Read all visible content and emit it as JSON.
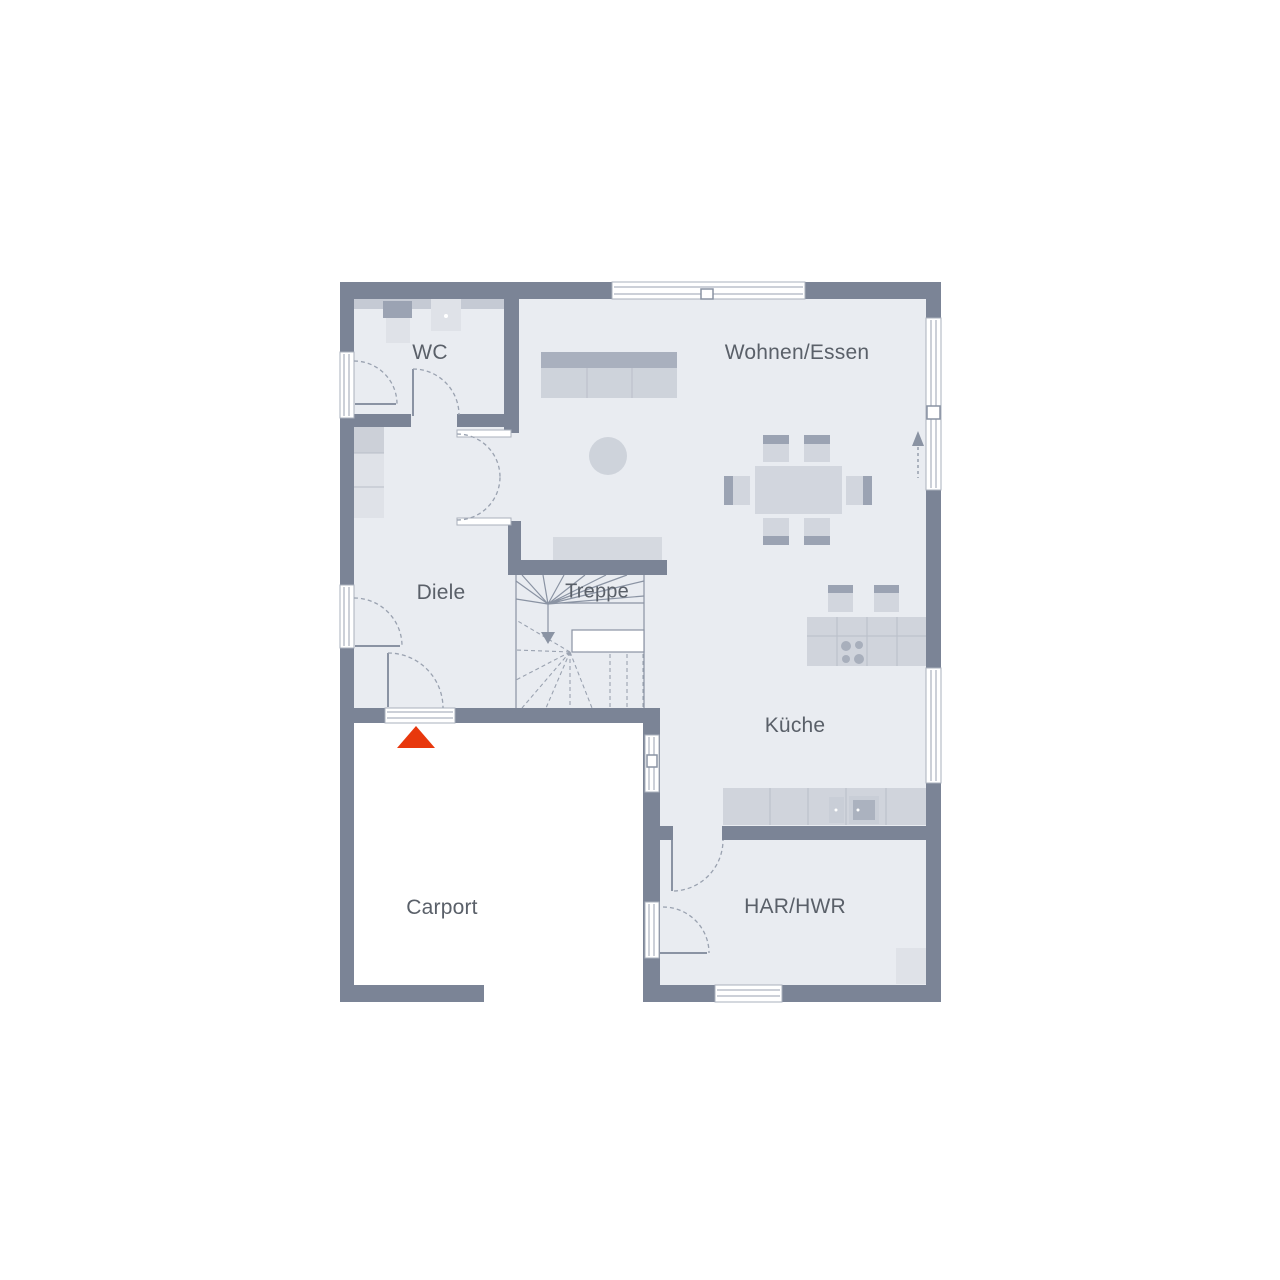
{
  "rooms": [
    {
      "id": "wc",
      "label": "WC"
    },
    {
      "id": "wohnen-essen",
      "label": "Wohnen/Essen"
    },
    {
      "id": "diele",
      "label": "Diele"
    },
    {
      "id": "treppe",
      "label": "Treppe"
    },
    {
      "id": "kueche",
      "label": "Küche"
    },
    {
      "id": "carport",
      "label": "Carport"
    },
    {
      "id": "har-hwr",
      "label": "HAR/HWR"
    }
  ],
  "markers": [
    {
      "id": "entrance-marker",
      "meaning": "entrance triangle",
      "color": "#E8380D"
    },
    {
      "id": "direction-arrow",
      "meaning": "dashed arrow pointing up along right wall"
    },
    {
      "id": "stairs-arrow",
      "meaning": "arrow pointing down the stair run"
    }
  ],
  "colors": {
    "wall": "#7B8496",
    "floor": "#E9ECF1",
    "carport": "#FFFFFF",
    "accent": "#E8380D",
    "line": "#8A93A3",
    "arc": "#9AA2B0",
    "text": "#5A6069",
    "furn-light": "#D2D6DE",
    "furn-dark": "#9BA3B3",
    "furn-mid": "#C5CAD4",
    "furn-pale": "#DFE2E8"
  }
}
